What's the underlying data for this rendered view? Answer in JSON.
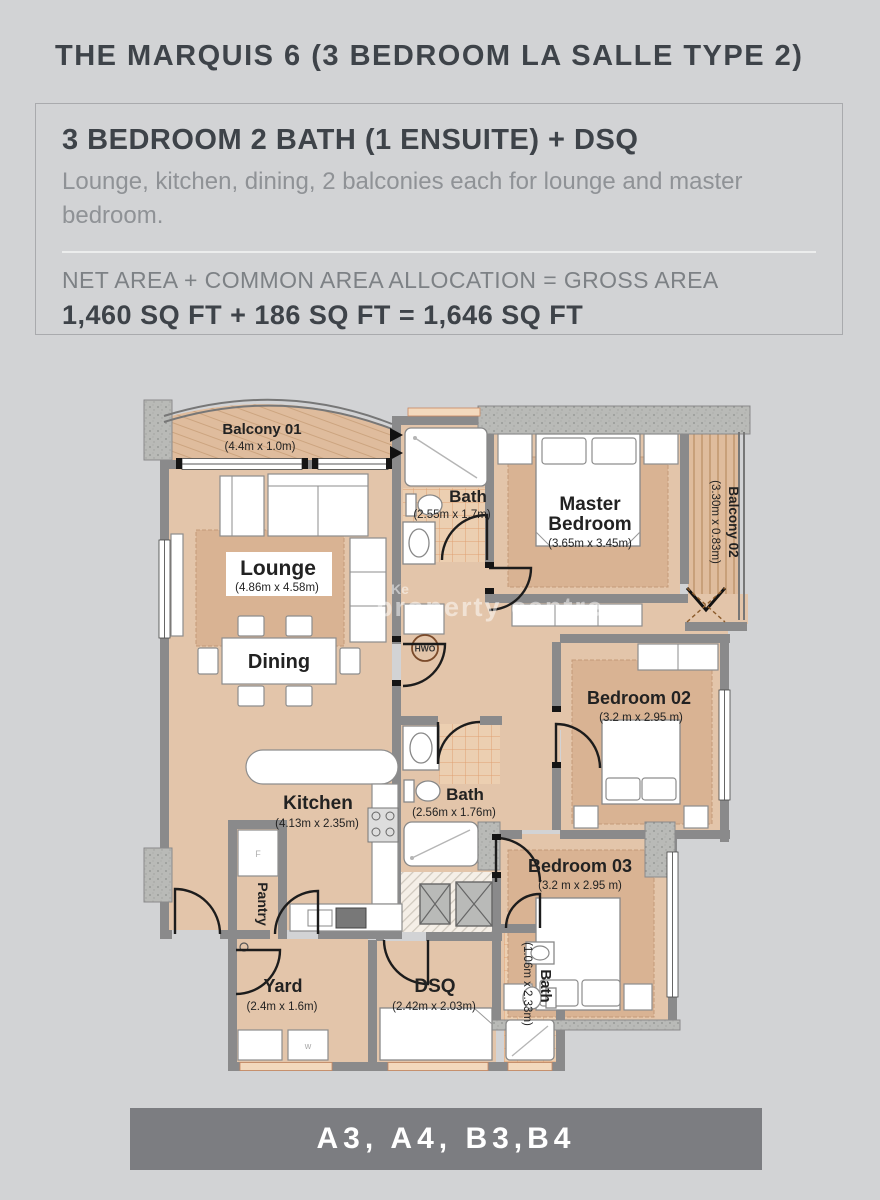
{
  "page": {
    "title": "THE MARQUIS 6 (3 BEDROOM LA SALLE TYPE 2)",
    "footer": "A3, A4, B3,B4",
    "watermark_small": "Ke",
    "watermark_main": "property centre"
  },
  "summary": {
    "heading": "3 BEDROOM 2 BATH (1 ENSUITE) + DSQ",
    "description": "Lounge, kitchen, dining, 2 balconies each for lounge and master bedroom.",
    "area_formula": "NET AREA + COMMON AREA ALLOCATION = GROSS AREA",
    "area_values": "1,460 SQ FT + 186 SQ FT = 1,646 SQ FT"
  },
  "floorplan": {
    "rooms": {
      "balcony01": {
        "name": "Balcony 01",
        "dims": "(4.4m x 1.0m)"
      },
      "lounge": {
        "name": "Lounge",
        "dims": "(4.86m x 4.58m)"
      },
      "dining": {
        "name": "Dining"
      },
      "kitchen": {
        "name": "Kitchen",
        "dims": "(4.13m x 2.35m)"
      },
      "pantry": {
        "name": "Pantry"
      },
      "yard": {
        "name": "Yard",
        "dims": "(2.4m x 1.6m)"
      },
      "dsq": {
        "name": "DSQ",
        "dims": "(2.42m x 2.03m)"
      },
      "dsq_bath": {
        "name": "Bath",
        "dims": "(1.06m x 2.33m)"
      },
      "bedroom02": {
        "name": "Bedroom 02",
        "dims": "(3.2 m x 2.95 m)"
      },
      "bedroom03": {
        "name": "Bedroom 03",
        "dims": "(3.2 m x 2.95 m)"
      },
      "main_bath": {
        "name": "Bath",
        "dims": "(2.56m x 1.76m)"
      },
      "ensuite_bath": {
        "name": "Bath",
        "dims": "(2.55m x 1.7m)"
      },
      "master": {
        "name_line1": "Master",
        "name_line2": "Bedroom",
        "dims": "(3.65m x 3.45m)"
      },
      "balcony02": {
        "name": "Balcony 02",
        "dims": "(3.30m x 0.83m)"
      }
    },
    "equipment": {
      "hwo": "HWO",
      "fridge": "F",
      "washer": "w"
    }
  },
  "colors": {
    "page_bg": "#d2d3d5",
    "text_dark": "#3e4349",
    "text_gray": "#8f9296",
    "footer_bg": "#7c7d81",
    "room_fill": "#e3c5aa",
    "rug_fill": "#d9b393",
    "wall": "#8a8a8b",
    "tile_line": "#dfa173"
  }
}
